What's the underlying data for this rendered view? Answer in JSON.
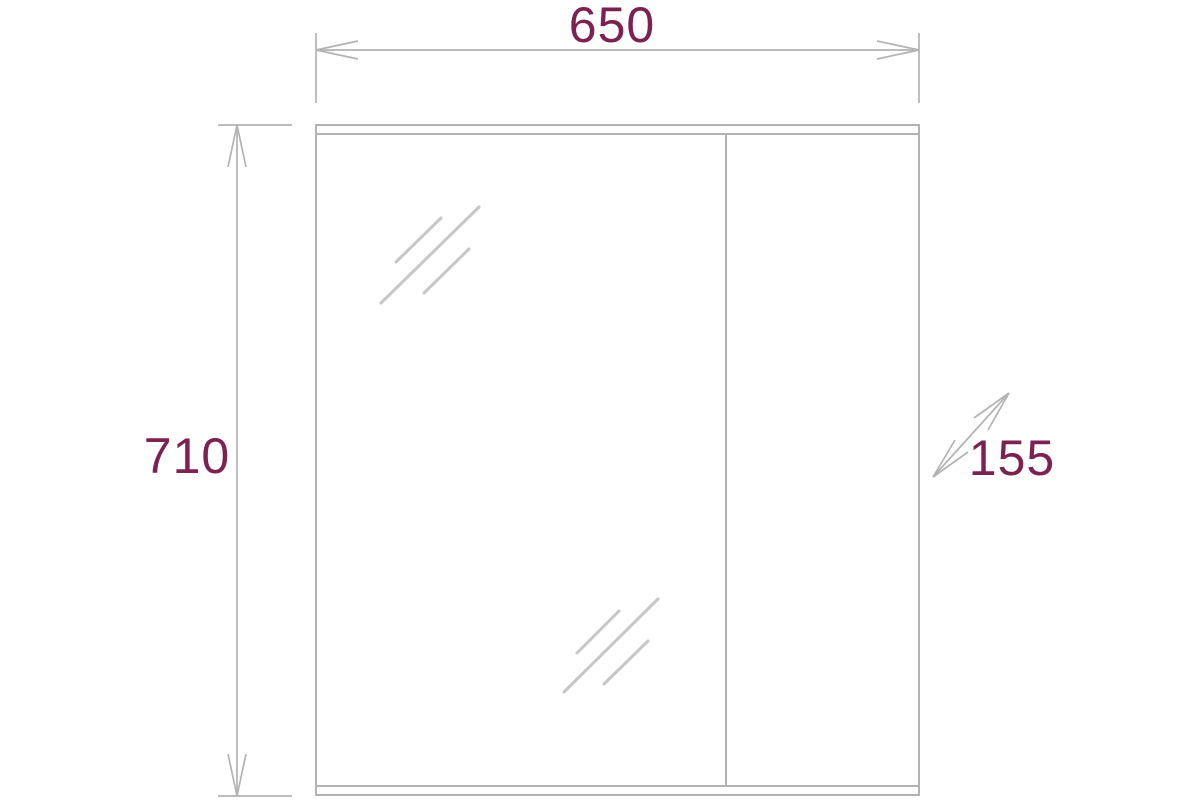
{
  "drawing": {
    "type": "technical dimension drawing",
    "colors": {
      "background-color": "#ffffff",
      "line-color": "#b3b3b5",
      "shine-color": "#c7c7c9",
      "accent-color": "#7c2150"
    },
    "dimensions": {
      "width": {
        "label": "650"
      },
      "height": {
        "label": "710"
      },
      "depth": {
        "label": "155"
      }
    }
  }
}
